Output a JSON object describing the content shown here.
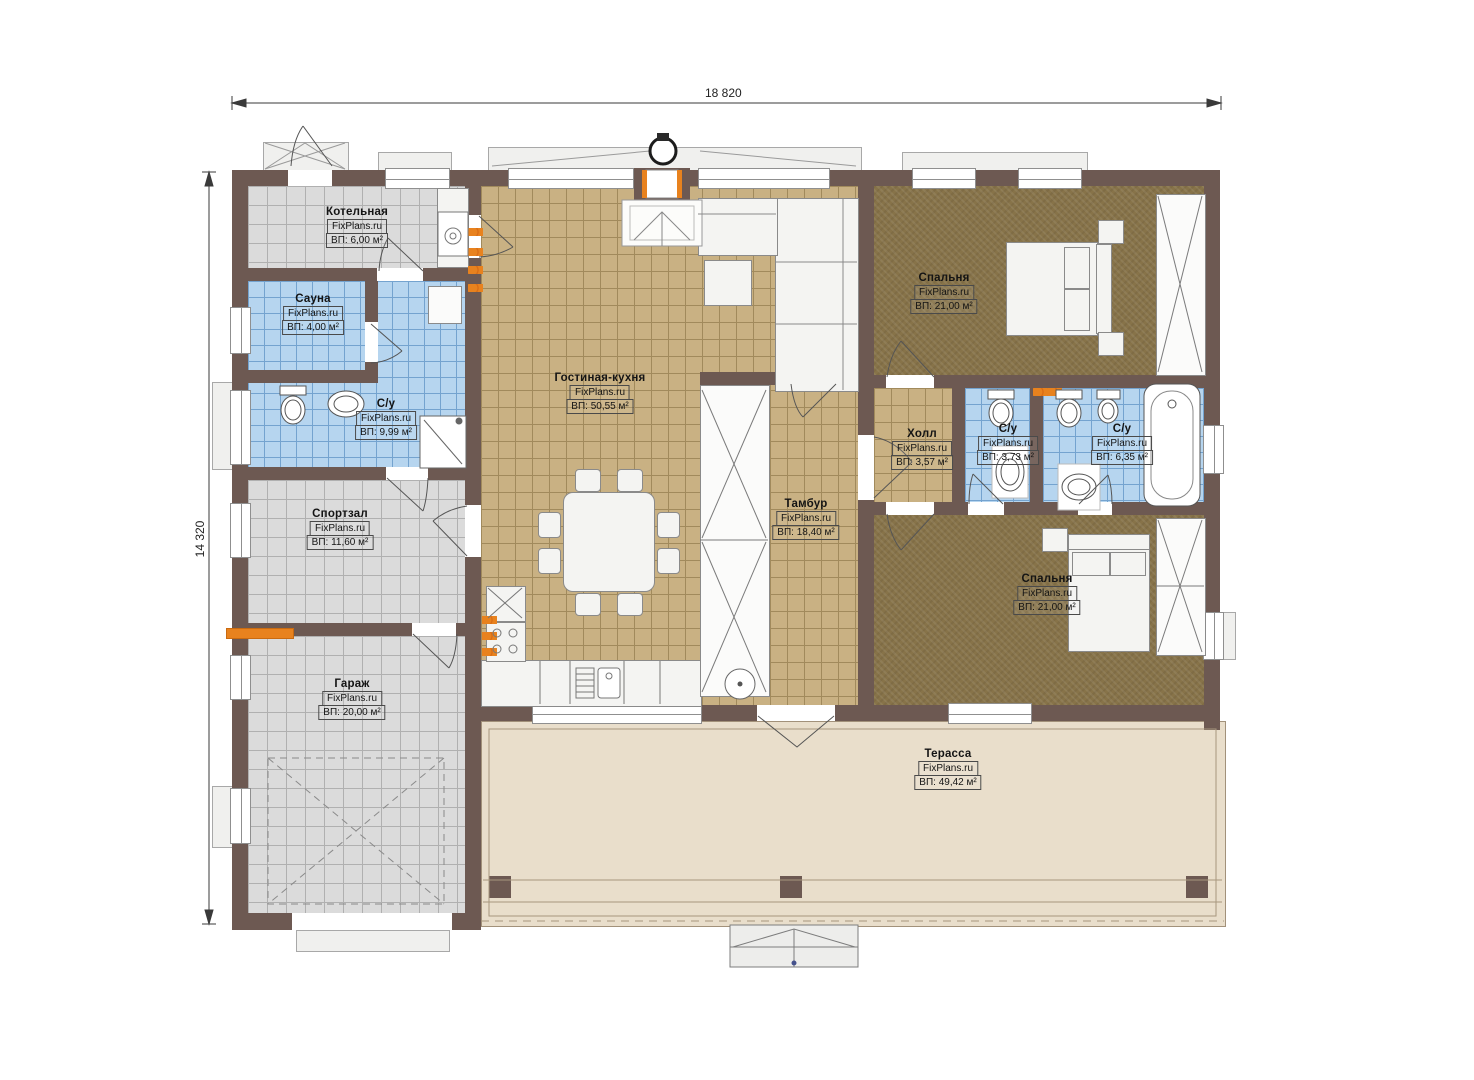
{
  "dimensions": {
    "width": "18 820",
    "height": "14 320"
  },
  "rooms": [
    {
      "id": "boiler",
      "name": "Котельная",
      "brand": "FixPlans.ru",
      "area": "ВП: 6,00 м²"
    },
    {
      "id": "sauna",
      "name": "Сауна",
      "brand": "FixPlans.ru",
      "area": "ВП: 4,00 м²"
    },
    {
      "id": "bathroom-left",
      "name": "С/у",
      "brand": "FixPlans.ru",
      "area": "ВП: 9,99 м²"
    },
    {
      "id": "gym",
      "name": "Спортзал",
      "brand": "FixPlans.ru",
      "area": "ВП: 11,60 м²"
    },
    {
      "id": "garage",
      "name": "Гараж",
      "brand": "FixPlans.ru",
      "area": "ВП: 20,00 м²"
    },
    {
      "id": "living-kitchen",
      "name": "Гостиная-кухня",
      "brand": "FixPlans.ru",
      "area": "ВП: 50,55 м²"
    },
    {
      "id": "vestibule",
      "name": "Тамбур",
      "brand": "FixPlans.ru",
      "area": "ВП: 18,40 м²"
    },
    {
      "id": "hall",
      "name": "Холл",
      "brand": "FixPlans.ru",
      "area": "ВП: 3,57 м²"
    },
    {
      "id": "bathroom-small",
      "name": "С/у",
      "brand": "FixPlans.ru",
      "area": "ВП: 3,73 м²"
    },
    {
      "id": "bathroom-master",
      "name": "С/у",
      "brand": "FixPlans.ru",
      "area": "ВП: 6,35 м²"
    },
    {
      "id": "bedroom-top",
      "name": "Спальня",
      "brand": "FixPlans.ru",
      "area": "ВП: 21,00 м²"
    },
    {
      "id": "bedroom-bottom",
      "name": "Спальня",
      "brand": "FixPlans.ru",
      "area": "ВП: 21,00 м²"
    },
    {
      "id": "terrace",
      "name": "Терасса",
      "brand": "FixPlans.ru",
      "area": "ВП: 49,42 м²"
    }
  ],
  "colors": {
    "wall": "#6d5952",
    "tile_grey": "#dbdbdb",
    "tile_blue": "#b6d5ef",
    "tile_tan": "#c9b183",
    "carpet": "#877349",
    "terrace": "#e9decb",
    "accent_orange": "#e8821e"
  }
}
